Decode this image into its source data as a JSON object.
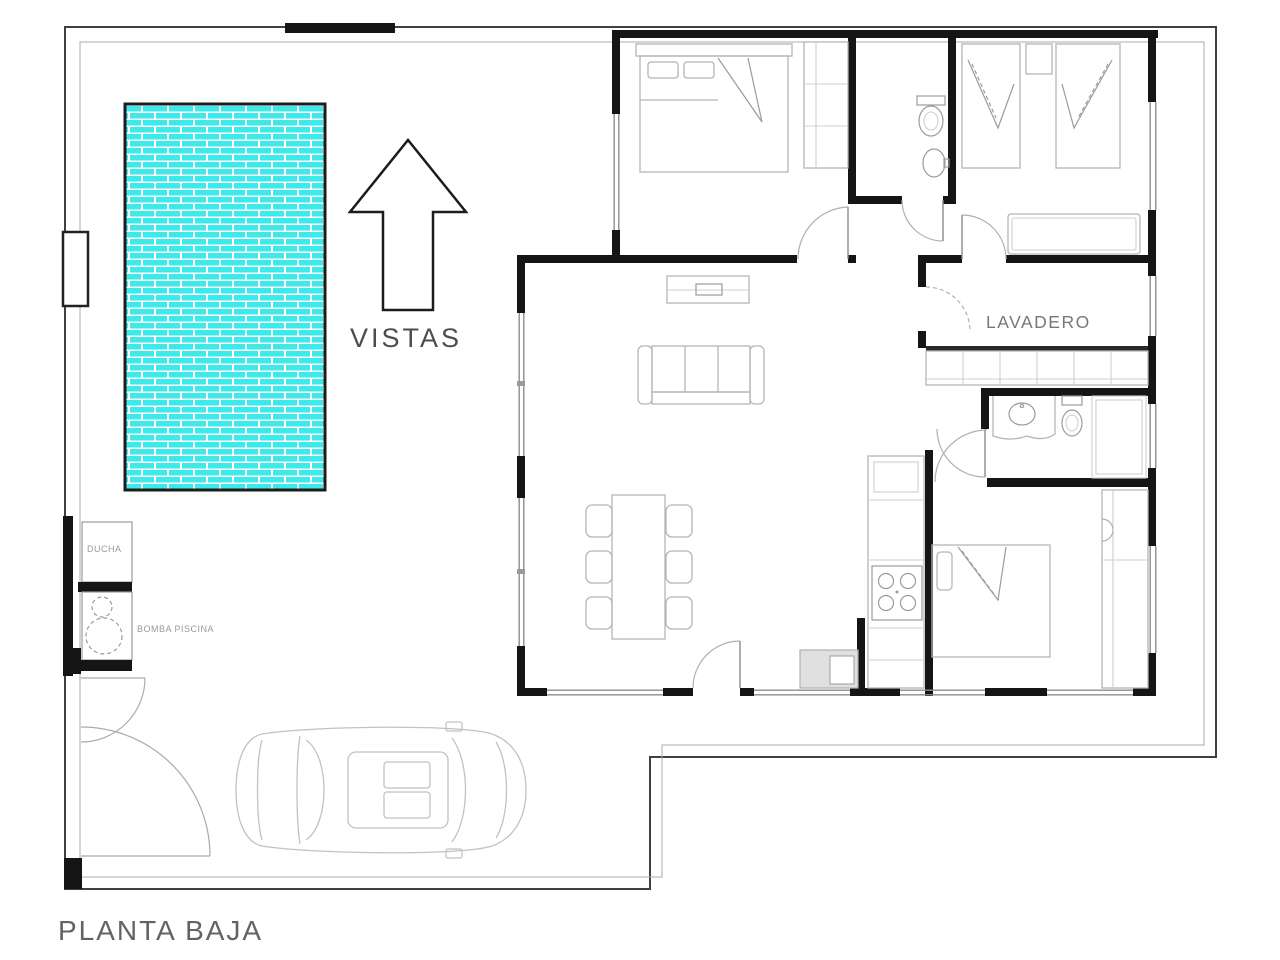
{
  "title": {
    "floor_label": "PLANTA BAJA"
  },
  "labels": {
    "views": "VISTAS",
    "views_arrow_direction": "up",
    "laundry": "LAVADERO",
    "shower": "DUCHA",
    "pool_pump": "BOMBA PISCINA"
  },
  "colors": {
    "pool_water": "#3EE9E9",
    "pool_mortar": "#ffffff",
    "wall": "#151515",
    "fence": "#3f3f3f",
    "furniture_line": "#b5b5b5",
    "door_arc": "#b0b0b0",
    "label_text": "#636363",
    "small_label_text": "#9a9a9a"
  }
}
